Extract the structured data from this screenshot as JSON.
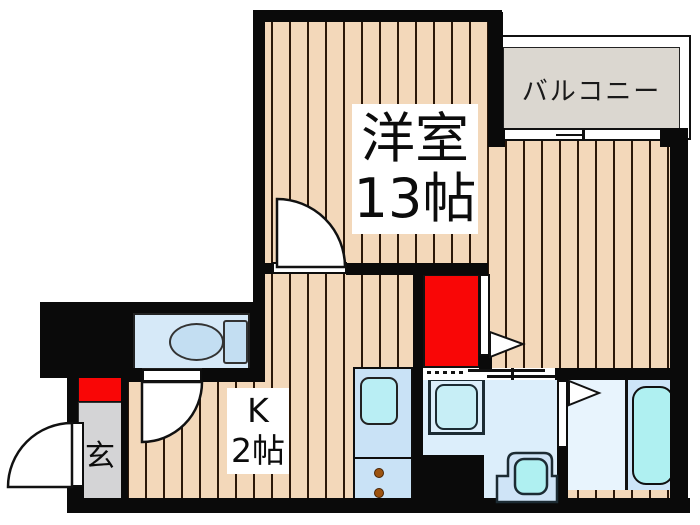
{
  "floorplan": {
    "rooms": {
      "main_room": {
        "name_label": "洋室",
        "size_label": "13帖"
      },
      "kitchen": {
        "name_label": "K",
        "size_label": "2帖"
      },
      "balcony": {
        "label": "バルコニー"
      },
      "entrance": {
        "label": "玄"
      }
    },
    "fixtures": [
      "toilet",
      "bathtub",
      "kitchen-sink",
      "stove-burners",
      "washing-machine",
      "washbasin",
      "sliding-door",
      "hinged-doors"
    ],
    "colors": {
      "wall": "#0a0a0a",
      "wood_floor": "#f3d8ba",
      "wood_plank_line": "#2b1708",
      "balcony_floor": "#dbd7d0",
      "toilet_floor": "#d6e9f8",
      "fixture_blue": "#c3def2",
      "washroom_floor": "#dceefb",
      "bathroom_floor": "#e8f4fd",
      "tub_platform": "#cde5f8",
      "cyan_fixture": "#aff0f1",
      "counter_blue": "#c9e2f6",
      "closet_red": "#f90606",
      "genkan_gray": "#d4d4d6",
      "burner_brown": "#9c5310",
      "label_text": "#0c0c0c"
    }
  }
}
